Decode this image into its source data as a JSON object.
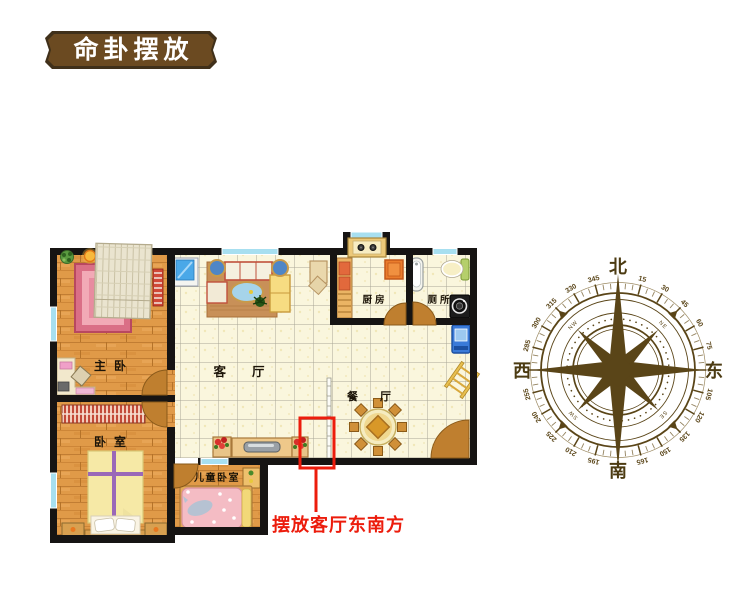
{
  "title_badge": {
    "label": "命卦摆放"
  },
  "floorplan": {
    "rooms": {
      "master_bedroom": "主卧",
      "bedroom": "卧室",
      "living_room": "客厅",
      "dining_room": "餐厅",
      "kitchen": "厨房",
      "toilet": "厕所",
      "kids_bedroom": "儿童卧室"
    }
  },
  "annotation": {
    "label": "摆放客厅东南方"
  },
  "compass": {
    "color": "#5a4518",
    "cardinals": [
      {
        "dir": "north",
        "label": "北"
      },
      {
        "dir": "east",
        "label": "东"
      },
      {
        "dir": "south",
        "label": "南"
      },
      {
        "dir": "west",
        "label": "西"
      }
    ],
    "degree_labels": [
      15,
      30,
      45,
      60,
      75,
      105,
      120,
      135,
      150,
      165,
      195,
      210,
      225,
      240,
      255,
      285,
      300,
      315,
      330,
      345
    ],
    "intercardinal_labels": [
      {
        "label": "NE",
        "angle": 45
      },
      {
        "label": "SE",
        "angle": 135
      },
      {
        "label": "SW",
        "angle": 225
      },
      {
        "label": "NW",
        "angle": 315
      }
    ]
  },
  "colors": {
    "accent-red": "#ec1c0c",
    "badge-bg": "#6b4a21",
    "badge-border": "#40301a",
    "badge-text": "#ffffff",
    "compass-brown": "#5a4518",
    "wall-black": "#161413",
    "window-blue": "#a7dff0",
    "door-brown": "#bf7f2f"
  }
}
